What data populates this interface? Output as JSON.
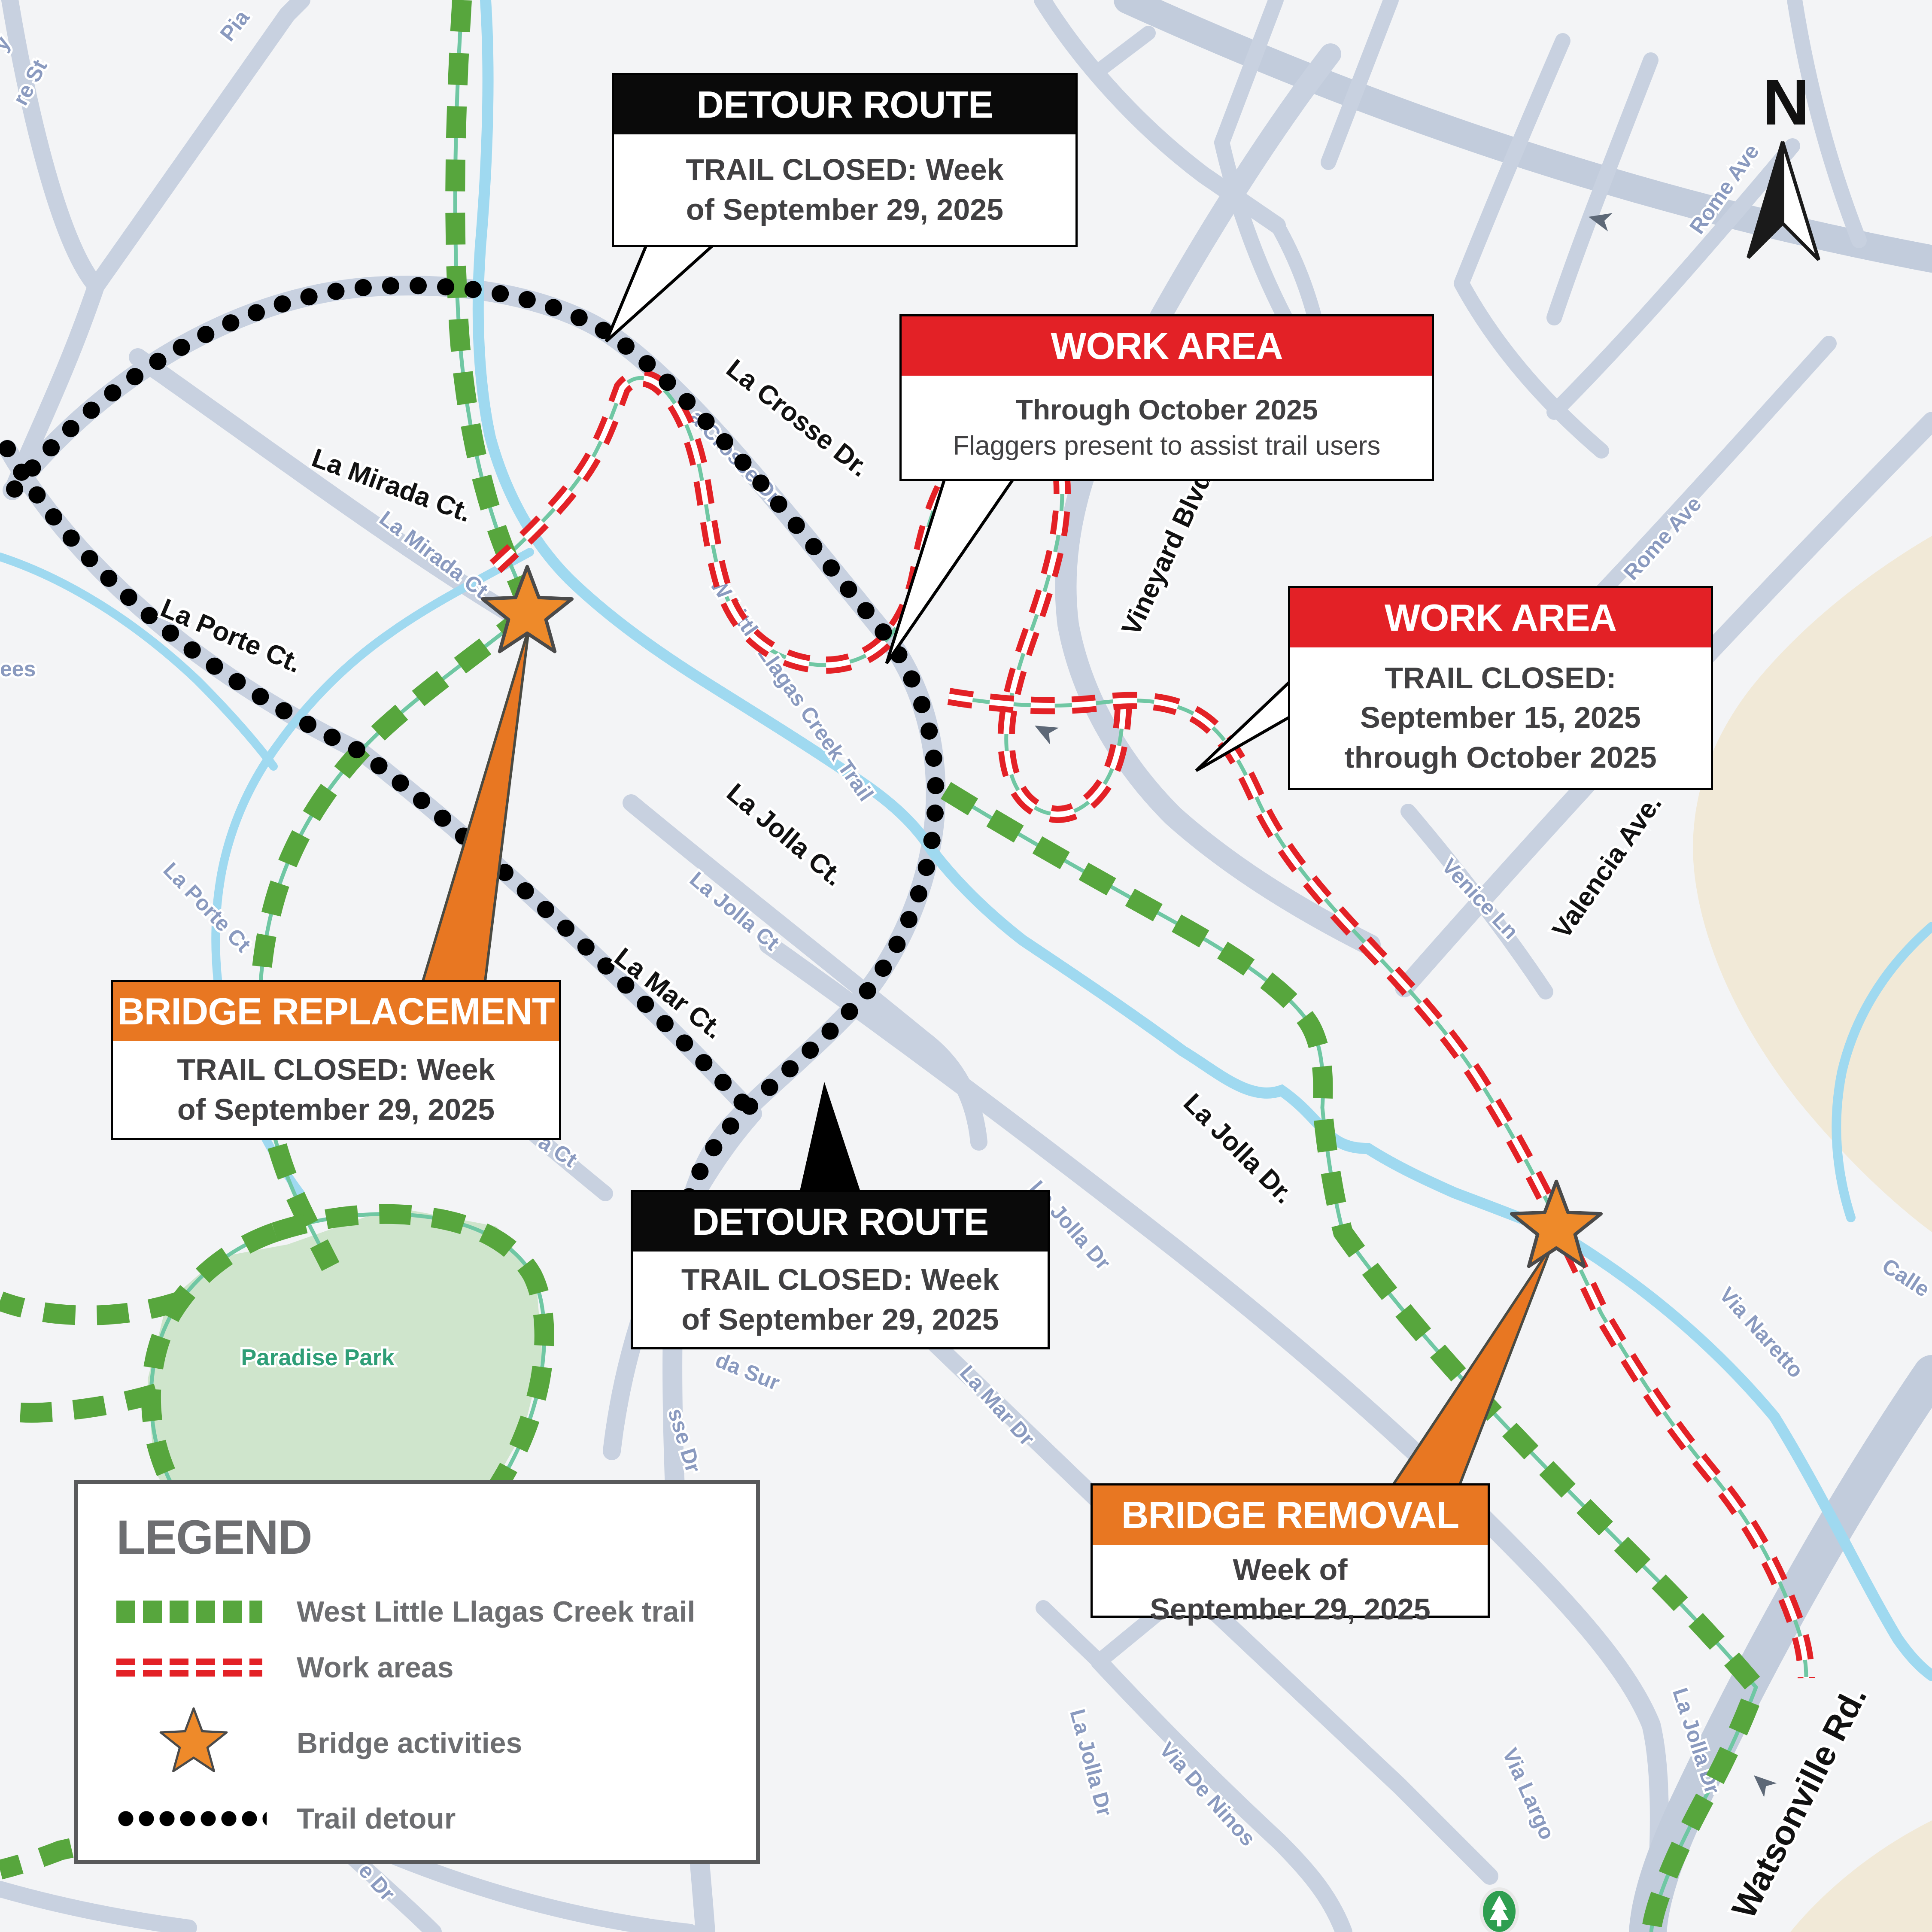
{
  "compass": {
    "north": "N"
  },
  "park": {
    "name": "Paradise Park"
  },
  "callouts": {
    "detour1": {
      "title": "DETOUR ROUTE",
      "line1": "TRAIL CLOSED: Week",
      "line2": "of September 29, 2025"
    },
    "work1": {
      "title": "WORK AREA",
      "line1": "Through October 2025",
      "line2": "Flaggers present to assist trail users"
    },
    "work2": {
      "title": "WORK AREA",
      "line1": "TRAIL CLOSED:",
      "line2": "September 15, 2025",
      "line3": "through October 2025"
    },
    "bridge_replacement": {
      "title": "BRIDGE REPLACEMENT",
      "line1": "TRAIL CLOSED: Week",
      "line2": "of September 29, 2025"
    },
    "detour2": {
      "title": "DETOUR ROUTE",
      "line1": "TRAIL CLOSED: Week",
      "line2": "of September 29, 2025"
    },
    "bridge_removal": {
      "title": "BRIDGE REMOVAL",
      "line1": "Week of",
      "line2": "September 29, 2025"
    }
  },
  "legend": {
    "title": "LEGEND",
    "trail": "West Little Llagas Creek trail",
    "work": "Work areas",
    "bridge": "Bridge activities",
    "detour": "Trail detour"
  },
  "streets": {
    "la_mirada": "La Mirada Ct.",
    "la_porte": "La Porte Ct.",
    "la_crosse": "La Crosse Dr.",
    "vineyard": "Vineyard Blvd.",
    "la_jolla_ct": "La Jolla Ct.",
    "la_mar": "La Mar Ct.",
    "la_jolla_dr": "La Jolla Dr.",
    "valencia": "Valencia Ave.",
    "watsonville": "Watsonville Rd."
  },
  "basemap": {
    "re_st": "re St",
    "pia": "Pia",
    "y": "y",
    "ees": "ees",
    "la_mirada": "La Mirada Ct",
    "la_porte": "La Porte Ct",
    "la_crosse": "La Crosse Dr",
    "creek_trail": "W Little Llagas Creek Trail",
    "la_jolla_ct": "La Jolla Ct",
    "la_jolla_dr1": "La Jolla Dr",
    "la_jolla_dr2": "La Jolla Dr",
    "la_jolla_dr3": "La Jolla Dr",
    "rome1": "Rome Ave",
    "rome2": "Rome Ave",
    "venice": "Venice Ln",
    "calle": "Calle",
    "via_naretto": "Via Naretto",
    "via_largo": "Via Largo",
    "via_de_ninos": "Via De Ninos",
    "la_mar_dr": "La Mar Dr",
    "da_sur": "da Sur",
    "sse_dr": "sse Dr",
    "e_dr": "e Dr",
    "a_ct": "a Ct"
  },
  "colors": {
    "trail_green": "#57a63d",
    "work_red": "#e32126",
    "bridge_orange": "#e87722",
    "detour_black": "#000000",
    "creek_blue": "#9fd9f0",
    "road_gray": "#c8d1e0",
    "legend_gray": "#6d6e71"
  }
}
